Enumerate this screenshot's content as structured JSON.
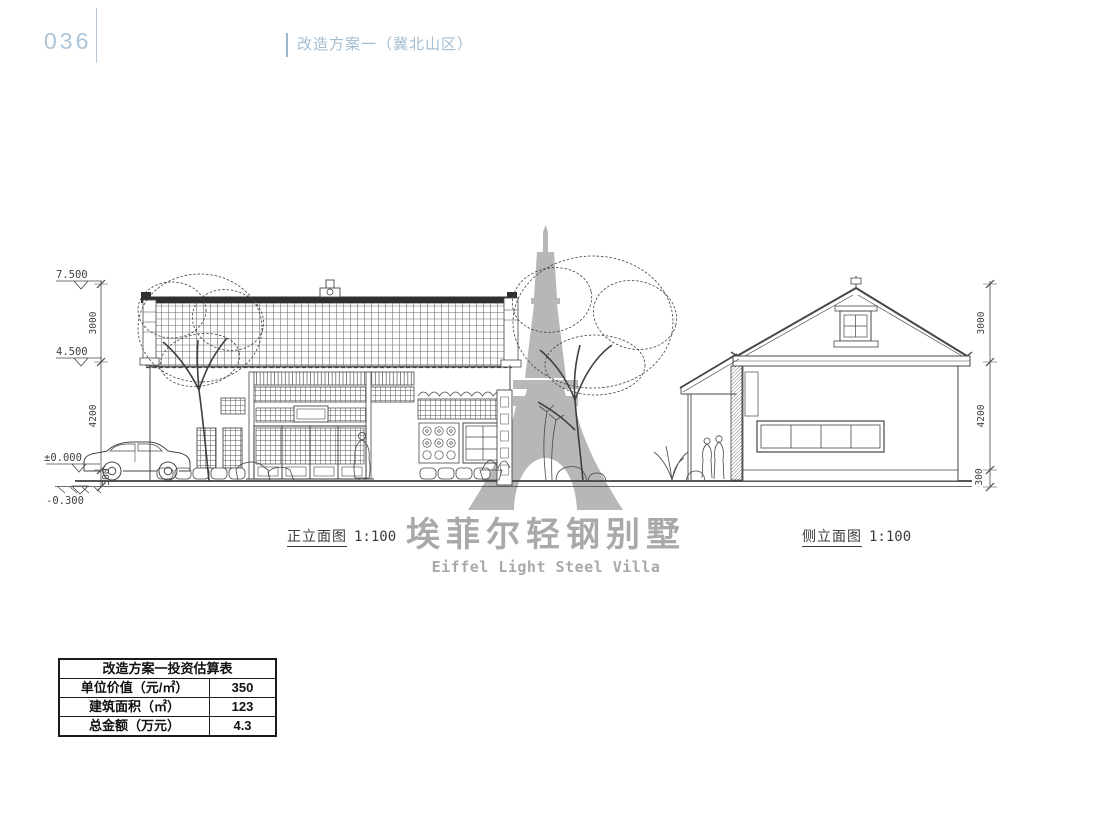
{
  "page": {
    "number": "036",
    "section_title": "改造方案一（冀北山区）",
    "background": "#ffffff",
    "accent_color": "#a3bdd1"
  },
  "elevations": {
    "front": {
      "label": "正立面图",
      "scale": "1:100"
    },
    "side": {
      "label": "侧立面图",
      "scale": "1:100"
    }
  },
  "levels": {
    "roof_top": "7.500",
    "eave": "4.500",
    "zero": "±0.000",
    "ground": "-0.300"
  },
  "dims_left": [
    "3000",
    "4200",
    "300"
  ],
  "dims_right": [
    "3000",
    "4200",
    "300"
  ],
  "watermark": {
    "brand_cn": "埃菲尔轻钢别墅",
    "brand_en": "Eiffel Light Steel Villa",
    "color": "#b7b7b7"
  },
  "table": {
    "title": "改造方案一投资估算表",
    "rows": [
      {
        "label": "单位价值（元/㎡）",
        "value": "350"
      },
      {
        "label": "建筑面积（㎡）",
        "value": "123"
      },
      {
        "label": "总金额（万元）",
        "value": "4.3"
      }
    ]
  }
}
